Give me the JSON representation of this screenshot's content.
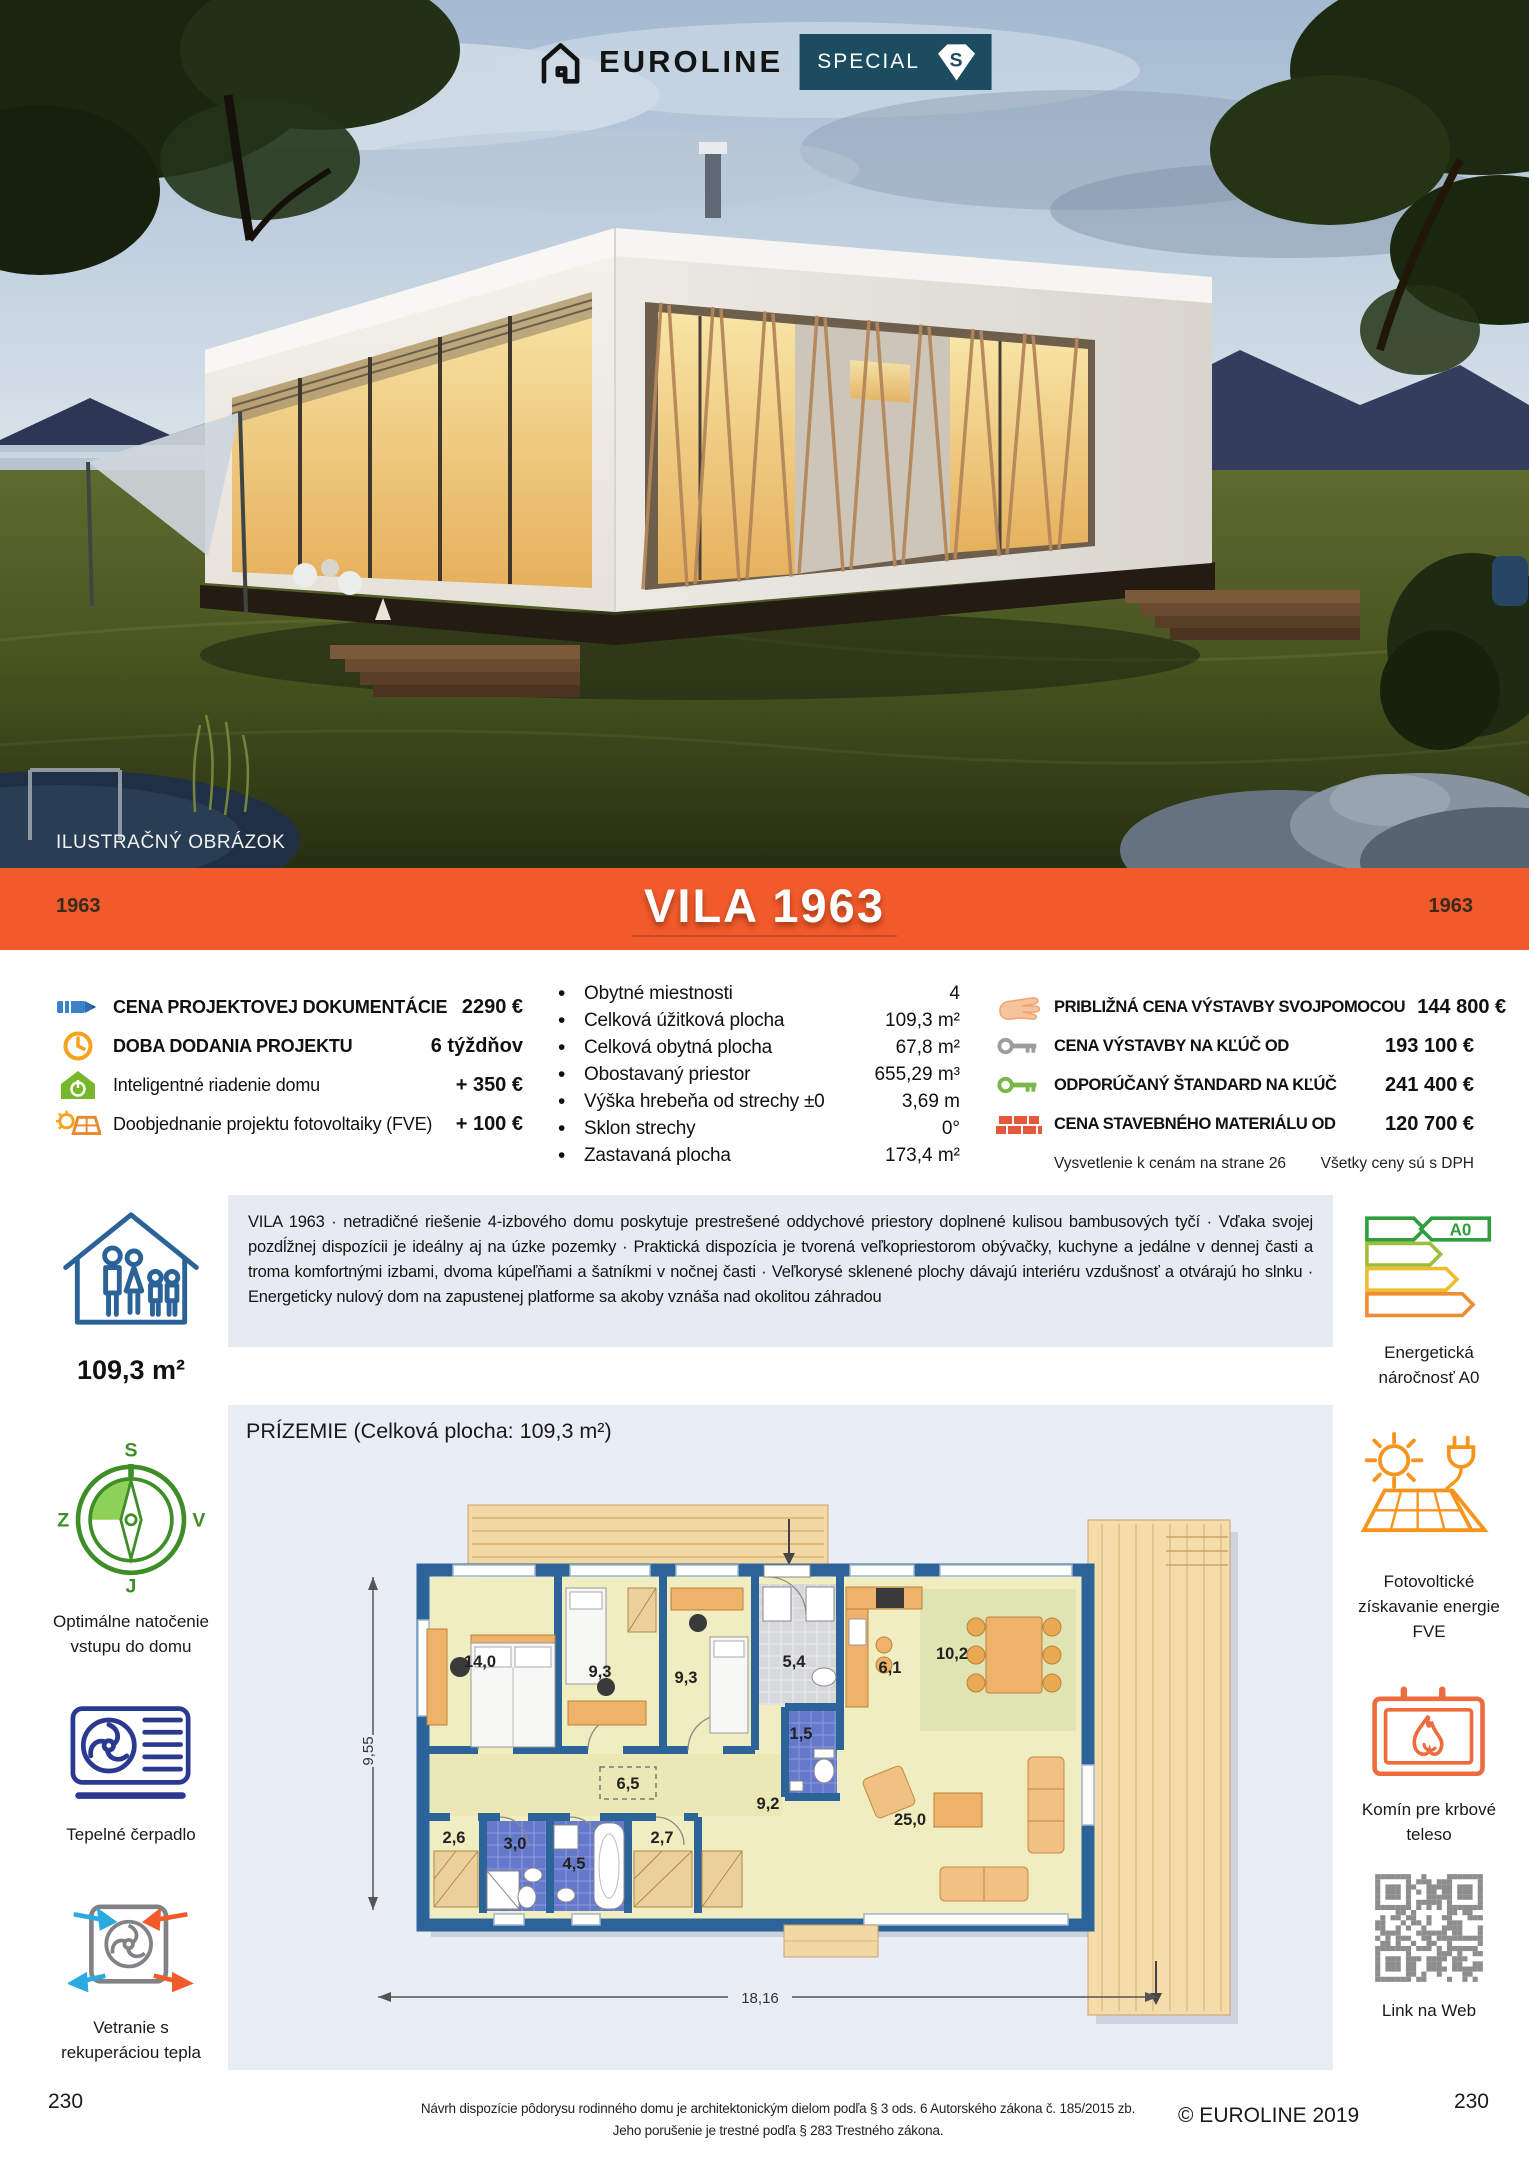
{
  "hero": {
    "brand": "EUROLINE",
    "special_label": "SPECIAL",
    "special_badge_letter": "S",
    "illustration_note": "ILUSTRAČNÝ OBRÁZOK"
  },
  "banner": {
    "code_left": "1963",
    "title": "VILA 1963",
    "code_right": "1963",
    "accent_color": "#f15a2b"
  },
  "pricing_left": {
    "rows": [
      {
        "icon": "pencil-icon",
        "label": "CENA PROJEKTOVEJ DOKUMENTÁCIE",
        "value": "2290 €"
      },
      {
        "icon": "clock-icon",
        "label": "DOBA DODANIA PROJEKTU",
        "value": "6 týždňov"
      },
      {
        "icon": "smart-home-icon",
        "label": "Inteligentné riadenie domu",
        "value": "+ 350 €"
      },
      {
        "icon": "solar-project-icon",
        "label": "Doobjednanie projektu fotovoltaiky (FVE)",
        "value": "+ 100 €"
      }
    ]
  },
  "specs": {
    "items": [
      {
        "label": "Obytné miestnosti",
        "value": "4"
      },
      {
        "label": "Celková úžitková plocha",
        "value": "109,3 m²"
      },
      {
        "label": "Celková obytná plocha",
        "value": "67,8 m²"
      },
      {
        "label": "Obostavaný priestor",
        "value": "655,29 m³"
      },
      {
        "label": "Výška hrebeňa od strechy ±0",
        "value": "3,69 m"
      },
      {
        "label": "Sklon strechy",
        "value": "0°"
      },
      {
        "label": "Zastavaná plocha",
        "value": "173,4 m²"
      }
    ]
  },
  "pricing_right": {
    "rows": [
      {
        "icon": "hand-icon",
        "label": "PRIBLIŽNÁ CENA VÝSTAVBY SVOJPOMOCOU",
        "value": "144 800 €"
      },
      {
        "icon": "key-gray-icon",
        "label": "CENA VÝSTAVBY NA KĽÚČ OD",
        "value": "193 100 €"
      },
      {
        "icon": "key-green-icon",
        "label": "ODPORÚČANÝ ŠTANDARD NA KĽÚČ",
        "value": "241 400 €"
      },
      {
        "icon": "bricks-icon",
        "label": "CENA STAVEBNÉHO MATERIÁLU OD",
        "value": "120 700 €"
      }
    ],
    "footnote_left": "Vysvetlenie k cenám na strane 26",
    "footnote_right": "Všetky ceny sú s DPH"
  },
  "description": {
    "text": "VILA 1963 · netradičné riešenie 4-izbového domu poskytuje prestrešené oddychové priestory doplnené kulisou bambusových tyčí · Vďaka svojej pozdĺžnej dispozícii je ideálny aj na úzke pozemky · Praktická dispozícia je tvorená veľkopriestorom obývačky, kuchyne a jedálne v dennej časti a troma komfortnými izbami, dvoma kúpeľňami a šatníkmi v nočnej časti · Veľkorysé sklenené plochy dávajú interiéru vzdušnosť a otvárajú ho slnku · Energeticky nulový dom na zapustenej platforme sa akoby vznáša nad okolitou záhradou"
  },
  "sidebar_left": {
    "area_label": "109,3 m²",
    "compass": {
      "north": "S",
      "east": "V",
      "south": "J",
      "west": "Z"
    },
    "orientation_label": "Optimálne natočenie vstupu do domu",
    "heatpump_label": "Tepelné čerpadlo",
    "ventilation_label": "Vetranie s rekuperáciou tepla"
  },
  "sidebar_right": {
    "energy_class": "A0",
    "energy_label": "Energetická náročnosť A0",
    "pv_label": "Fotovoltické získavanie energie FVE",
    "chimney_label": "Komín pre krbové teleso",
    "qr_label": "Link na Web"
  },
  "floorplan": {
    "heading": "PRÍZEMIE (Celková plocha: 109,3 m²)",
    "width_dim": "18,16",
    "height_dim": "9,55",
    "rooms": [
      {
        "label": "14,0"
      },
      {
        "label": "9,3"
      },
      {
        "label": "9,3"
      },
      {
        "label": "5,4"
      },
      {
        "label": "6,1"
      },
      {
        "label": "10,2"
      },
      {
        "label": "1,5"
      },
      {
        "label": "6,5"
      },
      {
        "label": "9,2"
      },
      {
        "label": "25,0"
      },
      {
        "label": "2,6"
      },
      {
        "label": "3,0"
      },
      {
        "label": "4,5"
      },
      {
        "label": "2,7"
      }
    ]
  },
  "footer": {
    "legal_line1": "Návrh dispozície pôdorysu rodinného domu je architektonickým dielom podľa § 3 ods. 6 Autorského zákona č. 185/2015 zb.",
    "legal_line2": "Jeho porušenie je trestné podľa § 283 Trestného zákona.",
    "copyright": "© EUROLINE 2019",
    "page_number_left": "230",
    "page_number_right": "230"
  }
}
